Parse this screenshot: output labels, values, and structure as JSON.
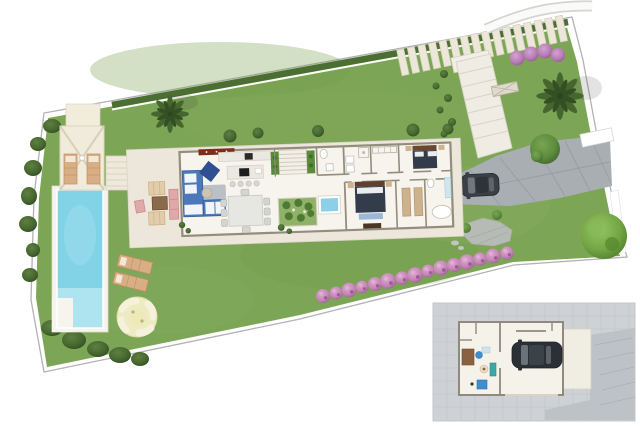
{
  "palette": {
    "bg": "#ffffff",
    "lawn": "#7da556",
    "lawnShadeDark": "#6f9a49",
    "lawnShadeLight": "#8fb468",
    "hedge": "#4b6e33",
    "boundary": "#b2b2b2",
    "deck": "#f6f4ed",
    "poolWater": "#83d3e6",
    "poolShallow": "#aee4ef",
    "platform": "#ece7da",
    "floor": "#f7f4ed",
    "wall": "#928d7d",
    "driveway": "#a8aeb1",
    "drivewayJoint": "#959ca0",
    "slab": "#ece7d8",
    "slabEdge": "#d3cdbb",
    "stone": "#b7bbb5",
    "pinkBush": "#c586b7",
    "purpleBush": "#b87cb5",
    "treeDark": "#46682f",
    "treeMid": "#5d8c3e",
    "treeBright": "#74a644",
    "palm": "#45672f",
    "gazeboRoof": "#f1ebdb",
    "lounger": "#d8ae85",
    "sofa": "#4a78b8",
    "armchair": "#2e4f91",
    "rug": "#3d5575",
    "counter": "#eae8e1",
    "cooktop": "#1e1e1e",
    "seat": "#d6d6d2",
    "sideboard": "#7c2d1c",
    "courtyard": "#8fb168",
    "jacuzzi": "#8ccfe8",
    "bedDark": "#323c4b",
    "headboard": "#6b4730",
    "bedBench": "#9cb8d8",
    "wardrobe": "#cdb28e",
    "bathBlue": "#cfe6ec",
    "firepit": "#ecebc2",
    "firepitSeat": "#f5f1da",
    "carBody": "#394046",
    "carGlass": "#6f777f",
    "insetPaving": "#ced2d5",
    "insetPavingLine": "#bdc2c6",
    "insetRamp": "#bdc2c7",
    "insetFloor": "#f5f2ea",
    "teal": "#3aa8a8",
    "desk": "#8a6242",
    "officeChair": "#3f8fd0",
    "insetCar": "#2b3037"
  },
  "scene": {
    "type": "villa-site-plan-rendering",
    "counts": {
      "stepping_stones": 16,
      "pink_bushes_row": 15,
      "purple_bushes_top": 4,
      "sun_loungers_lawn": 2,
      "sun_loungers_gazebo": 2,
      "kitchen_stools": 4,
      "dining_chairs": 8,
      "bedrooms": 3,
      "palm_trees": 2,
      "cars": 2
    },
    "areas": [
      "lawn",
      "hedge",
      "swimming-pool",
      "gazebo",
      "pool-steps",
      "sun-deck-loungers",
      "fire-pit-lounge",
      "main-house",
      "outdoor-lounge-terrace",
      "living-room",
      "kitchen",
      "dining-area",
      "entry-steps",
      "inner-courtyard",
      "jacuzzi",
      "bathroom",
      "dressing-room",
      "bedroom",
      "master-bedroom",
      "garden-stairs",
      "stepping-stone-path",
      "driveway",
      "parked-car",
      "stone-patio",
      "flower-bush-row",
      "basement-inset",
      "garage",
      "home-office"
    ]
  }
}
